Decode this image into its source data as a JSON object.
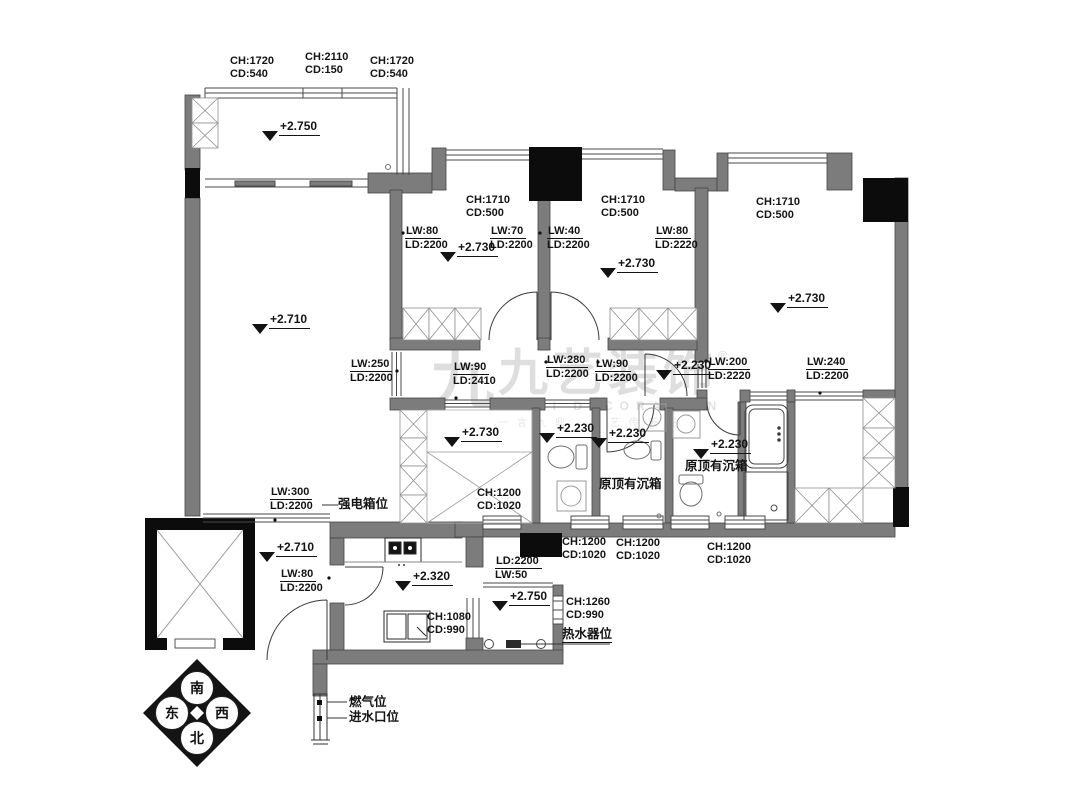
{
  "drawing": {
    "kind": "residential floor plan"
  },
  "watermark": {
    "logo_glyph": "九",
    "brand": "九艺装饰",
    "registered": "®",
    "latin": "JIUYI DECORATION",
    "slogan": "一言九鼎 · 艺传天下"
  },
  "compass": {
    "south": "南",
    "east": "东",
    "west": "西",
    "north": "北"
  },
  "annotations": [
    {
      "name": "window-label",
      "kind": "dim",
      "x": 230,
      "y": 55,
      "lines": [
        "CH:1720",
        "CD:540"
      ]
    },
    {
      "name": "window-label",
      "kind": "dim",
      "x": 305,
      "y": 51,
      "lines": [
        "CH:2110",
        "CD:150"
      ]
    },
    {
      "name": "window-label",
      "kind": "dim",
      "x": 370,
      "y": 55,
      "lines": [
        "CH:1720",
        "CD:540"
      ]
    },
    {
      "name": "window-label",
      "kind": "dim",
      "x": 466,
      "y": 194,
      "lines": [
        "CH:1710",
        "CD:500"
      ]
    },
    {
      "name": "window-label",
      "kind": "dim",
      "x": 601,
      "y": 194,
      "lines": [
        "CH:1710",
        "CD:500"
      ]
    },
    {
      "name": "window-label",
      "kind": "dim",
      "x": 756,
      "y": 196,
      "lines": [
        "CH:1710",
        "CD:500"
      ]
    },
    {
      "name": "window-label",
      "kind": "dim",
      "x": 477,
      "y": 487,
      "lines": [
        "CH:1200",
        "CD:1020"
      ]
    },
    {
      "name": "window-label",
      "kind": "dim",
      "x": 562,
      "y": 536,
      "lines": [
        "CH:1200",
        "CD:1020"
      ]
    },
    {
      "name": "window-label",
      "kind": "dim",
      "x": 616,
      "y": 537,
      "lines": [
        "CH:1200",
        "CD:1020"
      ]
    },
    {
      "name": "window-label",
      "kind": "dim",
      "x": 707,
      "y": 541,
      "lines": [
        "CH:1200",
        "CD:1020"
      ]
    },
    {
      "name": "window-label",
      "kind": "dim",
      "x": 427,
      "y": 611,
      "lines": [
        "CH:1080",
        "CD:990"
      ]
    },
    {
      "name": "window-label",
      "kind": "dim",
      "x": 566,
      "y": 596,
      "lines": [
        "CH:1260",
        "CD:990"
      ]
    },
    {
      "name": "opening-label",
      "kind": "open",
      "x": 405,
      "y": 225,
      "lines": [
        "LW:80",
        "LD:2200"
      ]
    },
    {
      "name": "opening-label",
      "kind": "open",
      "x": 490,
      "y": 225,
      "lines": [
        "LW:70",
        "LD:2200"
      ]
    },
    {
      "name": "opening-label",
      "kind": "open",
      "x": 547,
      "y": 225,
      "lines": [
        "LW:40",
        "LD:2200"
      ]
    },
    {
      "name": "opening-label",
      "kind": "open",
      "x": 655,
      "y": 225,
      "lines": [
        "LW:80",
        "LD:2220"
      ]
    },
    {
      "name": "opening-label",
      "kind": "open",
      "x": 350,
      "y": 358,
      "lines": [
        "LW:250",
        "LD:2200"
      ]
    },
    {
      "name": "opening-label",
      "kind": "open",
      "x": 453,
      "y": 361,
      "lines": [
        "LW:90",
        "LD:2410"
      ]
    },
    {
      "name": "opening-label",
      "kind": "open",
      "x": 546,
      "y": 354,
      "lines": [
        "LW:280",
        "LD:2200"
      ]
    },
    {
      "name": "opening-label",
      "kind": "open",
      "x": 595,
      "y": 358,
      "lines": [
        "LW:90",
        "LD:2200"
      ]
    },
    {
      "name": "opening-label",
      "kind": "open",
      "x": 708,
      "y": 356,
      "lines": [
        "LW:200",
        "LD:2220"
      ]
    },
    {
      "name": "opening-label",
      "kind": "open",
      "x": 806,
      "y": 356,
      "lines": [
        "LW:240",
        "LD:2200"
      ]
    },
    {
      "name": "opening-label",
      "kind": "open",
      "x": 270,
      "y": 486,
      "lines": [
        "LW:300",
        "LD:2200"
      ]
    },
    {
      "name": "opening-label",
      "kind": "open",
      "x": 280,
      "y": 568,
      "lines": [
        "LW:80",
        "LD:2200"
      ]
    },
    {
      "name": "opening-label",
      "kind": "open",
      "x": 495,
      "y": 555,
      "lines": [
        "LD:2200",
        "LW:50"
      ]
    },
    {
      "name": "elevation-marker",
      "kind": "elev",
      "x": 262,
      "y": 120,
      "text": "+2.750"
    },
    {
      "name": "elevation-marker",
      "kind": "elev",
      "x": 252,
      "y": 313,
      "text": "+2.710"
    },
    {
      "name": "elevation-marker",
      "kind": "elev",
      "x": 440,
      "y": 241,
      "text": "+2.730"
    },
    {
      "name": "elevation-marker",
      "kind": "elev",
      "x": 600,
      "y": 257,
      "text": "+2.730"
    },
    {
      "name": "elevation-marker",
      "kind": "elev",
      "x": 770,
      "y": 292,
      "text": "+2.730"
    },
    {
      "name": "elevation-marker",
      "kind": "elev",
      "x": 444,
      "y": 426,
      "text": "+2.730"
    },
    {
      "name": "elevation-marker",
      "kind": "elev",
      "x": 656,
      "y": 359,
      "text": "+2.230"
    },
    {
      "name": "elevation-marker",
      "kind": "elev",
      "x": 539,
      "y": 422,
      "text": "+2.230"
    },
    {
      "name": "elevation-marker",
      "kind": "elev",
      "x": 591,
      "y": 427,
      "text": "+2.230"
    },
    {
      "name": "elevation-marker",
      "kind": "elev",
      "x": 693,
      "y": 438,
      "text": "+2.230"
    },
    {
      "name": "elevation-marker",
      "kind": "elev",
      "x": 259,
      "y": 541,
      "text": "+2.710"
    },
    {
      "name": "elevation-marker",
      "kind": "elev",
      "x": 395,
      "y": 570,
      "text": "+2.320"
    },
    {
      "name": "elevation-marker",
      "kind": "elev",
      "x": 492,
      "y": 590,
      "text": "+2.750"
    },
    {
      "name": "note-strong-electric-box",
      "kind": "note",
      "x": 338,
      "y": 497,
      "text": "强电箱位"
    },
    {
      "name": "note-sunken-ceiling",
      "kind": "note",
      "x": 599,
      "y": 477,
      "text": "原顶有沉箱"
    },
    {
      "name": "note-sunken-ceiling",
      "kind": "note",
      "x": 685,
      "y": 459,
      "text": "原顶有沉箱"
    },
    {
      "name": "note-water-heater",
      "kind": "note",
      "u": true,
      "x": 562,
      "y": 627,
      "text": "热水器位"
    },
    {
      "name": "note-gas-position",
      "kind": "note",
      "x": 349,
      "y": 695,
      "text": "燃气位"
    },
    {
      "name": "note-water-inlet",
      "kind": "note",
      "x": 349,
      "y": 710,
      "text": "进水口位"
    }
  ]
}
